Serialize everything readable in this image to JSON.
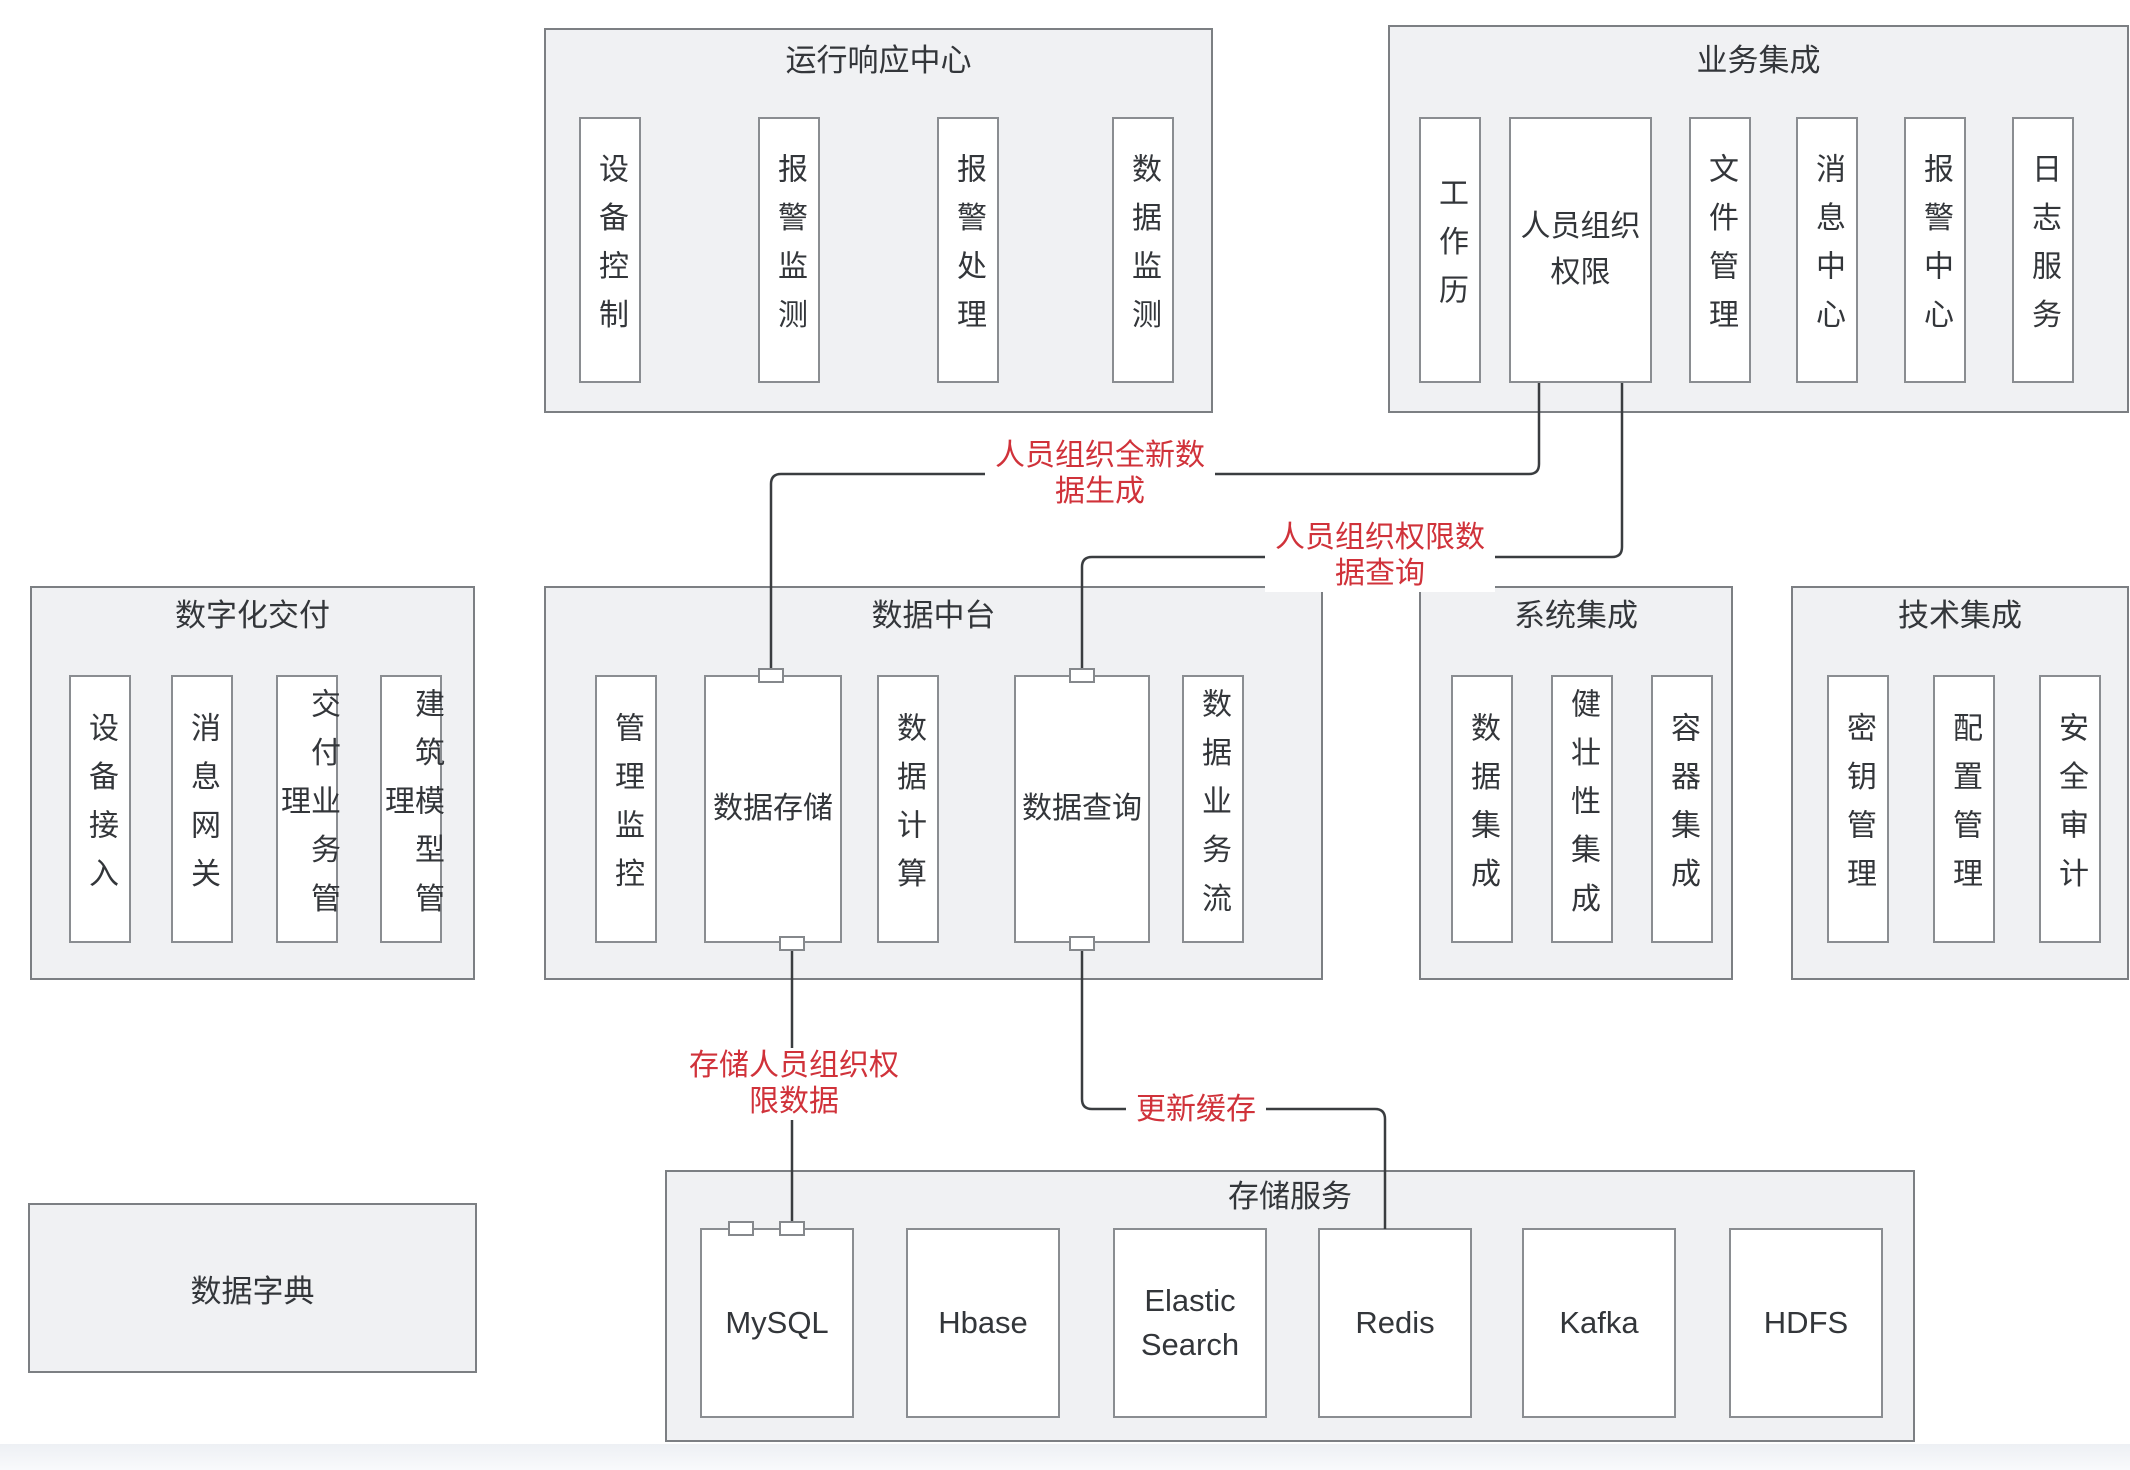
{
  "palette": {
    "page_background": "#ffffff",
    "container_fill": "#f0f1f3",
    "container_border": "#7c7f83",
    "node_fill": "#ffffff",
    "node_border": "#8a8d91",
    "text": "#33363a",
    "edge_line": "#3a3d40",
    "edge_label_red": "#d0323a"
  },
  "groups": [
    {
      "id": "operation-response-center",
      "title": "运行响应中心",
      "items": [
        "设备控制",
        "报警监测",
        "报警处理",
        "数据监测"
      ]
    },
    {
      "id": "business-integration",
      "title": "业务集成",
      "items": [
        "工作历",
        "人员组织权限",
        "文件管理",
        "消息中心",
        "报警中心",
        "日志服务"
      ]
    },
    {
      "id": "digital-delivery",
      "title": "数字化交付",
      "items": [
        "设备接入",
        "消息网关",
        "交付业务管理",
        "建筑模型管理"
      ]
    },
    {
      "id": "data-middle-platform",
      "title": "数据中台",
      "items": [
        "管理监控",
        "数据存储",
        "数据计算",
        "数据查询",
        "数据业务流"
      ]
    },
    {
      "id": "system-integration",
      "title": "系统集成",
      "items": [
        "数据集成",
        "健壮性集成",
        "容器集成"
      ]
    },
    {
      "id": "technology-integration",
      "title": "技术集成",
      "items": [
        "密钥管理",
        "配置管理",
        "安全审计"
      ]
    },
    {
      "id": "storage-services",
      "title": "存储服务",
      "items": [
        "MySQL",
        "Hbase",
        "Elastic Search",
        "Redis",
        "Kafka",
        "HDFS"
      ]
    },
    {
      "id": "data-dictionary",
      "title": "数据字典",
      "items": []
    }
  ],
  "edges": [
    {
      "from": "人员组织权限",
      "to": "数据存储",
      "label": "人员组织全新数\n据生成"
    },
    {
      "from": "人员组织权限",
      "to": "数据查询",
      "label": "人员组织权限数\n据查询"
    },
    {
      "from": "数据存储",
      "to": "MySQL",
      "label": "存储人员组织权\n限数据"
    },
    {
      "from": "数据查询",
      "to": "Redis",
      "label": "更新缓存"
    }
  ]
}
